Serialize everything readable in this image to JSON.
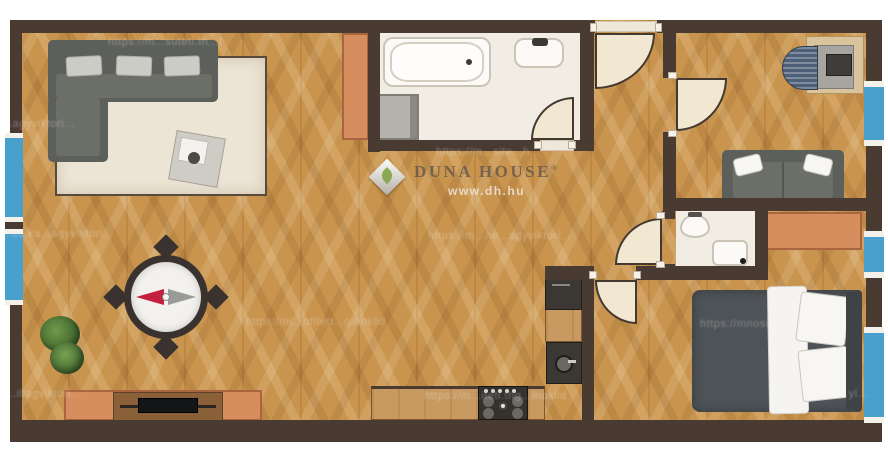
{
  "brand": {
    "logo_text": "DUNA HOUSE",
    "registered_mark": "®",
    "website": "www.dh.hu"
  },
  "compass": {
    "west_needle_color": "#c41f3e",
    "east_needle_color": "#9a9a98"
  },
  "colors": {
    "wall_brown": "#4a3b32",
    "window_blue": "#4aa0cc",
    "floor_wood": "#c9944e",
    "bathroom_floor": "#f1ede4",
    "rug_cream": "#ece4d4",
    "sofa_gray": "#5d5f5a",
    "bed_duvet_gray": "#4e5357",
    "cabinet_orange": "#d78e5e",
    "counter_wood": "#c89a62",
    "appliance_dark": "#3b3834",
    "door_cream": "#f2e7d0"
  },
  "watermarks": [
    {
      "text": "https://m...suteti.th...t",
      "x": 108,
      "y": 36
    },
    {
      "text": "...agyviktori...",
      "x": 2,
      "y": 118
    },
    {
      "text": "https://m...site...h...",
      "x": 436,
      "y": 146
    },
    {
      "text": "...cs.ka...agyviktori...",
      "x": 2,
      "y": 228
    },
    {
      "text": "https://m...ite...agyviktori...",
      "x": 428,
      "y": 230
    },
    {
      "text": "https://m...ofitett...glnoklid",
      "x": 246,
      "y": 316
    },
    {
      "text": "https://mnosite...",
      "x": 700,
      "y": 318
    },
    {
      "text": "...illagviktori...",
      "x": 6,
      "y": 388
    },
    {
      "text": "https://m...iteti.thg...lnoklid",
      "x": 424,
      "y": 390
    },
    {
      "text": "...yl...",
      "x": 838,
      "y": 388
    }
  ]
}
